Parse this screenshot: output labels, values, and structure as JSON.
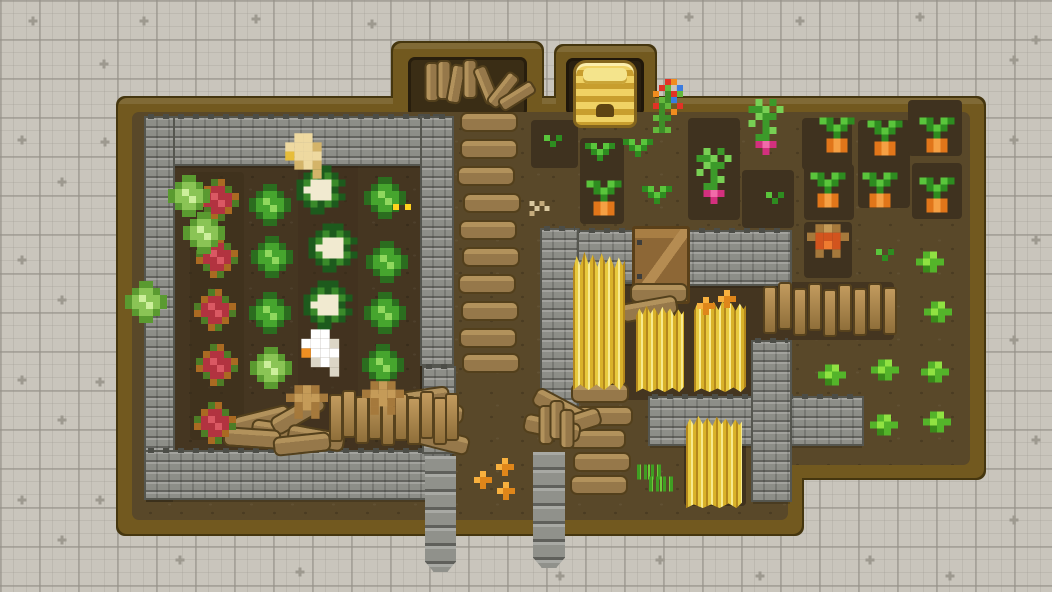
{
  "meta": {
    "title": "top-down pixel farm scene",
    "viewport": {
      "w": 1052,
      "h": 592
    }
  },
  "palette": {
    "background": "#c9c5bc",
    "grid_major": "#949087",
    "grid_minor": "#9e9a91",
    "wood_border": "#72591f",
    "wood_outline": "#45360f",
    "dirt_main": "#594829",
    "dirt_garden": "#453621",
    "dirt_plot": "#3f321f",
    "stone": "#8d8e88",
    "stone_dark": "#55564f",
    "wheat_gold": "#e7c93e",
    "cabbage_green": "#46a52e",
    "cabbage_red": "#b23340",
    "cauliflower_cream": "#f1ead0",
    "carrot_orange": "#e1761a",
    "radish_pink": "#d3307e",
    "beehive_gold": "#f0d264",
    "chick_orange": "#df861a"
  },
  "background": {
    "plus_marks": [
      [
        33,
        21
      ],
      [
        144,
        21
      ],
      [
        256,
        19
      ],
      [
        372,
        24
      ],
      [
        689,
        17
      ],
      [
        800,
        21
      ],
      [
        920,
        17
      ],
      [
        1036,
        40
      ],
      [
        104,
        64
      ],
      [
        22,
        140
      ],
      [
        105,
        142
      ],
      [
        62,
        182
      ],
      [
        22,
        260
      ],
      [
        62,
        300
      ],
      [
        22,
        380
      ],
      [
        100,
        382
      ],
      [
        62,
        420
      ],
      [
        22,
        500
      ],
      [
        100,
        500
      ],
      [
        62,
        540
      ],
      [
        180,
        560
      ],
      [
        300,
        572
      ],
      [
        560,
        576
      ],
      [
        660,
        560
      ],
      [
        760,
        576
      ],
      [
        870,
        560
      ],
      [
        950,
        576
      ],
      [
        1014,
        60
      ],
      [
        1014,
        140
      ],
      [
        1036,
        240
      ],
      [
        1014,
        340
      ],
      [
        1036,
        440
      ],
      [
        1014,
        520
      ]
    ]
  },
  "farm": {
    "wood": [
      {
        "x": 118,
        "y": 98,
        "w": 684,
        "h": 436
      },
      {
        "x": 788,
        "y": 98,
        "w": 196,
        "h": 380
      },
      {
        "x": 393,
        "y": 43,
        "w": 149,
        "h": 72
      },
      {
        "x": 556,
        "y": 46,
        "w": 99,
        "h": 70
      }
    ],
    "dirt": [
      {
        "x": 132,
        "y": 112,
        "w": 656,
        "h": 408
      },
      {
        "x": 779,
        "y": 112,
        "w": 191,
        "h": 353
      }
    ],
    "niches": [
      {
        "x": 408,
        "y": 57,
        "w": 119,
        "h": 60,
        "c": "#3a2d15"
      },
      {
        "x": 566,
        "y": 58,
        "w": 78,
        "h": 58,
        "c": "#2a2010"
      }
    ],
    "garden": {
      "x": 172,
      "y": 160,
      "w": 250,
      "h": 295
    },
    "plots": [
      {
        "x": 190,
        "y": 172,
        "w": 54,
        "h": 268,
        "c": "#3d2f1c",
        "o": 0.55
      },
      {
        "x": 298,
        "y": 163,
        "w": 60,
        "h": 295,
        "c": "#3d2f1c",
        "o": 0.45
      },
      {
        "x": 577,
        "y": 232,
        "w": 213,
        "h": 168,
        "c": "#443520"
      },
      {
        "x": 762,
        "y": 282,
        "w": 132,
        "h": 58,
        "c": "#443520"
      },
      {
        "x": 684,
        "y": 414,
        "w": 62,
        "h": 92,
        "c": "#3f311d"
      },
      {
        "x": 531,
        "y": 120,
        "w": 47,
        "h": 48
      },
      {
        "x": 580,
        "y": 138,
        "w": 44,
        "h": 86
      },
      {
        "x": 688,
        "y": 118,
        "w": 52,
        "h": 102
      },
      {
        "x": 742,
        "y": 170,
        "w": 52,
        "h": 58
      },
      {
        "x": 802,
        "y": 118,
        "w": 50,
        "h": 52
      },
      {
        "x": 858,
        "y": 120,
        "w": 52,
        "h": 88
      },
      {
        "x": 908,
        "y": 100,
        "w": 54,
        "h": 56
      },
      {
        "x": 804,
        "y": 164,
        "w": 50,
        "h": 56
      },
      {
        "x": 912,
        "y": 163,
        "w": 50,
        "h": 56
      },
      {
        "x": 804,
        "y": 222,
        "w": 48,
        "h": 56
      }
    ]
  },
  "walls": [
    {
      "x": 146,
      "y": 118,
      "w": 304,
      "h": 46
    },
    {
      "x": 146,
      "y": 118,
      "w": 27,
      "h": 380
    },
    {
      "x": 146,
      "y": 452,
      "w": 304,
      "h": 46
    },
    {
      "x": 422,
      "y": 118,
      "w": 30,
      "h": 246
    },
    {
      "x": 424,
      "y": 368,
      "w": 30,
      "h": 34
    },
    {
      "x": 424,
      "y": 406,
      "w": 30,
      "h": 46
    },
    {
      "x": 542,
      "y": 232,
      "w": 94,
      "h": 50
    },
    {
      "x": 682,
      "y": 232,
      "w": 108,
      "h": 52
    },
    {
      "x": 542,
      "y": 230,
      "w": 35,
      "h": 190
    },
    {
      "x": 650,
      "y": 398,
      "w": 212,
      "h": 46
    },
    {
      "x": 753,
      "y": 342,
      "w": 37,
      "h": 158
    }
  ],
  "pillars": [
    {
      "x": 425,
      "y": 456,
      "w": 31,
      "h": 116
    },
    {
      "x": 533,
      "y": 452,
      "w": 32,
      "h": 116
    }
  ],
  "gate": {
    "x": 632,
    "y": 226,
    "w": 52,
    "h": 72
  },
  "beehive": {
    "x": 576,
    "y": 63,
    "w": 58,
    "h": 62
  },
  "planks": {
    "h": [
      [
        489,
        122,
        0
      ],
      [
        489,
        149,
        0
      ],
      [
        486,
        176,
        0
      ],
      [
        492,
        203,
        0
      ],
      [
        488,
        230,
        0
      ],
      [
        491,
        257,
        0
      ],
      [
        487,
        284,
        0
      ],
      [
        490,
        311,
        0
      ],
      [
        488,
        338,
        0
      ],
      [
        491,
        363,
        0
      ],
      [
        600,
        393,
        0
      ],
      [
        604,
        416,
        0
      ],
      [
        597,
        439,
        0
      ],
      [
        602,
        462,
        0
      ],
      [
        599,
        485,
        0
      ],
      [
        560,
        408,
        28
      ],
      [
        573,
        424,
        -18
      ],
      [
        552,
        428,
        12
      ],
      [
        659,
        293,
        0
      ],
      [
        649,
        309,
        -10
      ],
      [
        262,
        420,
        -14
      ],
      [
        280,
        432,
        8
      ],
      [
        298,
        414,
        -30
      ],
      [
        316,
        438,
        10
      ],
      [
        252,
        438,
        4
      ],
      [
        302,
        444,
        -6
      ],
      [
        421,
        399,
        -8
      ],
      [
        435,
        412,
        6
      ],
      [
        424,
        428,
        -4
      ],
      [
        441,
        440,
        14
      ]
    ],
    "sticks": [
      [
        409,
        416,
        0
      ],
      [
        546,
        425,
        0
      ],
      [
        557,
        420,
        0
      ],
      [
        567,
        429,
        0
      ],
      [
        432,
        82,
        0
      ],
      [
        444,
        80,
        0
      ],
      [
        456,
        84,
        10
      ],
      [
        470,
        79,
        0
      ],
      [
        486,
        85,
        -22
      ],
      [
        503,
        90,
        38
      ],
      [
        517,
        96,
        58
      ]
    ],
    "posts": [
      [
        336,
        418
      ],
      [
        349,
        414
      ],
      [
        362,
        420
      ],
      [
        375,
        416
      ],
      [
        388,
        422
      ],
      [
        401,
        417
      ],
      [
        414,
        421
      ],
      [
        427,
        415
      ],
      [
        440,
        421
      ],
      [
        452,
        417
      ],
      [
        770,
        310
      ],
      [
        785,
        306
      ],
      [
        800,
        312
      ],
      [
        815,
        307
      ],
      [
        830,
        313
      ],
      [
        845,
        308
      ],
      [
        860,
        312
      ],
      [
        875,
        307
      ],
      [
        890,
        311
      ]
    ]
  },
  "wheat": [
    {
      "x": 573,
      "y": 252,
      "w": 52,
      "h": 138
    },
    {
      "x": 636,
      "y": 306,
      "w": 48,
      "h": 86
    },
    {
      "x": 694,
      "y": 300,
      "w": 52,
      "h": 92
    },
    {
      "x": 686,
      "y": 416,
      "w": 56,
      "h": 92
    }
  ],
  "entities": [
    {
      "t": "red-cabbage",
      "x": 218,
      "y": 200
    },
    {
      "t": "red-cabbage",
      "x": 217,
      "y": 257
    },
    {
      "t": "red-cabbage",
      "x": 215,
      "y": 310
    },
    {
      "t": "red-cabbage",
      "x": 217,
      "y": 365
    },
    {
      "t": "red-cabbage",
      "x": 215,
      "y": 423
    },
    {
      "t": "green-cabbage",
      "x": 270,
      "y": 205
    },
    {
      "t": "green-cabbage",
      "x": 272,
      "y": 257
    },
    {
      "t": "green-cabbage",
      "x": 270,
      "y": 313
    },
    {
      "t": "green-cabbage",
      "x": 385,
      "y": 198
    },
    {
      "t": "green-cabbage",
      "x": 387,
      "y": 262
    },
    {
      "t": "green-cabbage",
      "x": 385,
      "y": 313
    },
    {
      "t": "green-cabbage",
      "x": 383,
      "y": 365
    },
    {
      "t": "light-cabbage",
      "x": 189,
      "y": 196
    },
    {
      "t": "light-cabbage",
      "x": 204,
      "y": 233
    },
    {
      "t": "light-cabbage",
      "x": 146,
      "y": 302
    },
    {
      "t": "light-cabbage",
      "x": 271,
      "y": 368
    },
    {
      "t": "cauliflower",
      "x": 321,
      "y": 190
    },
    {
      "t": "cauliflower",
      "x": 333,
      "y": 248
    },
    {
      "t": "cauliflower",
      "x": 328,
      "y": 305
    },
    {
      "t": "carrot",
      "x": 604,
      "y": 198
    },
    {
      "t": "carrot",
      "x": 837,
      "y": 135
    },
    {
      "t": "carrot",
      "x": 885,
      "y": 138
    },
    {
      "t": "carrot",
      "x": 937,
      "y": 135
    },
    {
      "t": "carrot",
      "x": 828,
      "y": 190
    },
    {
      "t": "carrot",
      "x": 880,
      "y": 190
    },
    {
      "t": "carrot",
      "x": 937,
      "y": 195
    },
    {
      "t": "radish",
      "x": 714,
      "y": 176
    },
    {
      "t": "radish",
      "x": 766,
      "y": 127
    },
    {
      "t": "seedling",
      "x": 600,
      "y": 152
    },
    {
      "t": "seedling",
      "x": 638,
      "y": 148
    },
    {
      "t": "seedling",
      "x": 657,
      "y": 195
    },
    {
      "t": "sprout",
      "x": 553,
      "y": 141
    },
    {
      "t": "sprout",
      "x": 775,
      "y": 198
    },
    {
      "t": "sprout",
      "x": 885,
      "y": 255
    },
    {
      "t": "bush",
      "x": 930,
      "y": 262
    },
    {
      "t": "bush",
      "x": 938,
      "y": 312
    },
    {
      "t": "bush",
      "x": 832,
      "y": 375
    },
    {
      "t": "bush",
      "x": 885,
      "y": 370
    },
    {
      "t": "bush",
      "x": 935,
      "y": 372
    },
    {
      "t": "bush",
      "x": 884,
      "y": 425
    },
    {
      "t": "bush",
      "x": 937,
      "y": 422
    },
    {
      "t": "grass",
      "x": 650,
      "y": 472
    },
    {
      "t": "grass",
      "x": 662,
      "y": 484
    },
    {
      "t": "flower-bush",
      "x": 668,
      "y": 106
    },
    {
      "t": "sparkle",
      "x": 405,
      "y": 210
    },
    {
      "t": "seeds",
      "x": 542,
      "y": 211
    },
    {
      "t": "chick",
      "x": 483,
      "y": 480
    },
    {
      "t": "chick",
      "x": 505,
      "y": 467
    },
    {
      "t": "chick",
      "x": 506,
      "y": 491
    },
    {
      "t": "chick",
      "x": 706,
      "y": 306
    },
    {
      "t": "chick",
      "x": 727,
      "y": 299
    },
    {
      "t": "dwarf",
      "x": 307,
      "y": 402,
      "s": 1.2
    },
    {
      "t": "dwarf",
      "x": 383,
      "y": 398,
      "s": 1.2
    },
    {
      "t": "dwarf-redbeard",
      "x": 828,
      "y": 241,
      "s": 1.2
    },
    {
      "t": "tan-goose",
      "x": 308,
      "y": 156,
      "s": 1.3
    },
    {
      "t": "white-goose",
      "x": 325,
      "y": 353,
      "s": 1.35
    }
  ],
  "interactable_types": [
    "red-cabbage",
    "green-cabbage",
    "light-cabbage",
    "cauliflower",
    "carrot",
    "radish",
    "seedling",
    "sprout",
    "bush",
    "grass",
    "flower-bush",
    "chick",
    "dwarf",
    "dwarf-redbeard",
    "tan-goose",
    "white-goose"
  ]
}
